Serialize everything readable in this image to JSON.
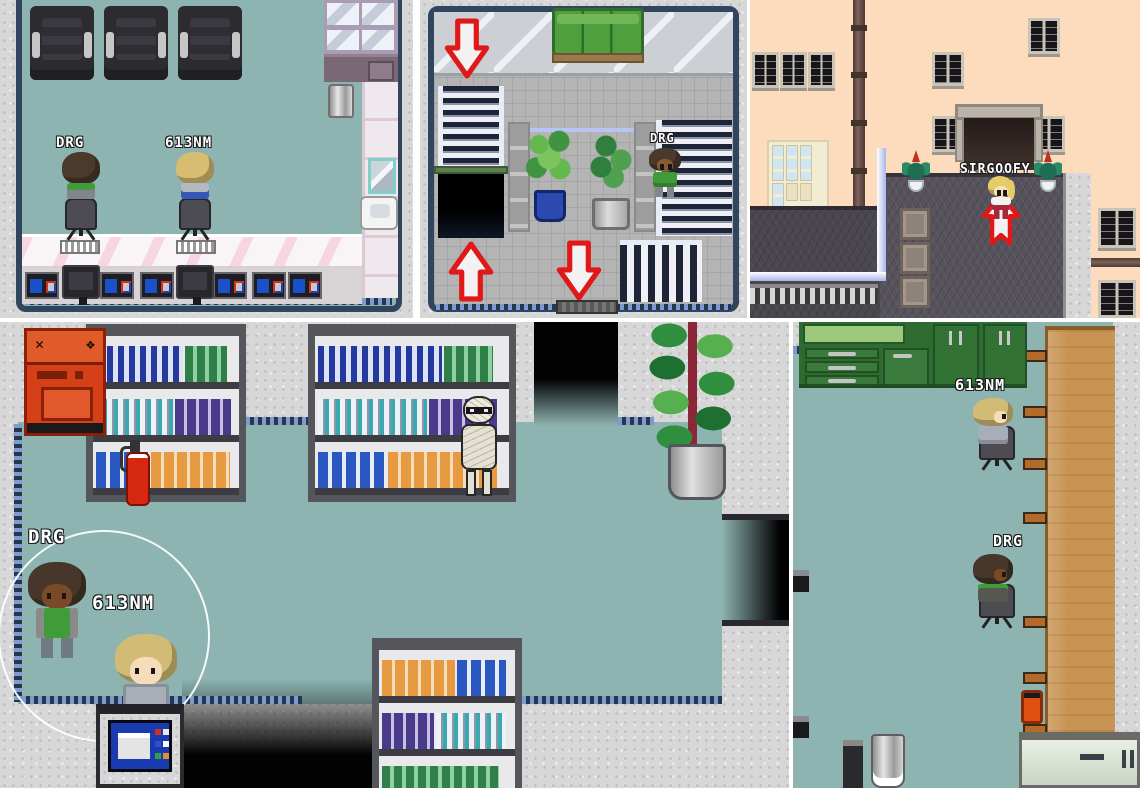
{
  "panels": {
    "salon": {
      "characters": [
        {
          "label": "DRG"
        },
        {
          "label": "613NM"
        }
      ]
    },
    "mall": {
      "characters": [
        {
          "label": "DRG"
        }
      ]
    },
    "street": {
      "characters": [
        {
          "label": "SIRGOOFY"
        }
      ]
    },
    "archive": {
      "characters": [
        {
          "label": "DRG"
        },
        {
          "label": "613NM"
        }
      ]
    },
    "office": {
      "characters": [
        {
          "label": "613NM"
        },
        {
          "label": "DRG"
        }
      ]
    }
  },
  "palette": {
    "teal_floor": "#8EB4B1",
    "stone_floor": "#D7D7D7",
    "navy_frame": "#31455E",
    "trim_blue": "#7D9BD0",
    "tile_gray": "#B4B4B4",
    "peach_wall": "#FCDCBD",
    "roof_gray": "#57535D",
    "arrow_red": "#E01818",
    "arrow_fill": "#F2F2F2",
    "sofa_green": "#4F9F3F",
    "cabinet_green": "#2E6B31",
    "table_wood": "#C89454",
    "machine_red": "#D64018",
    "nametag_text": "#FFFFFF"
  },
  "icons": {
    "arrow_down": "thick red-outlined down arrow",
    "arrow_up": "thick red-outlined up arrow",
    "highlight_circle": "white circle outline"
  }
}
